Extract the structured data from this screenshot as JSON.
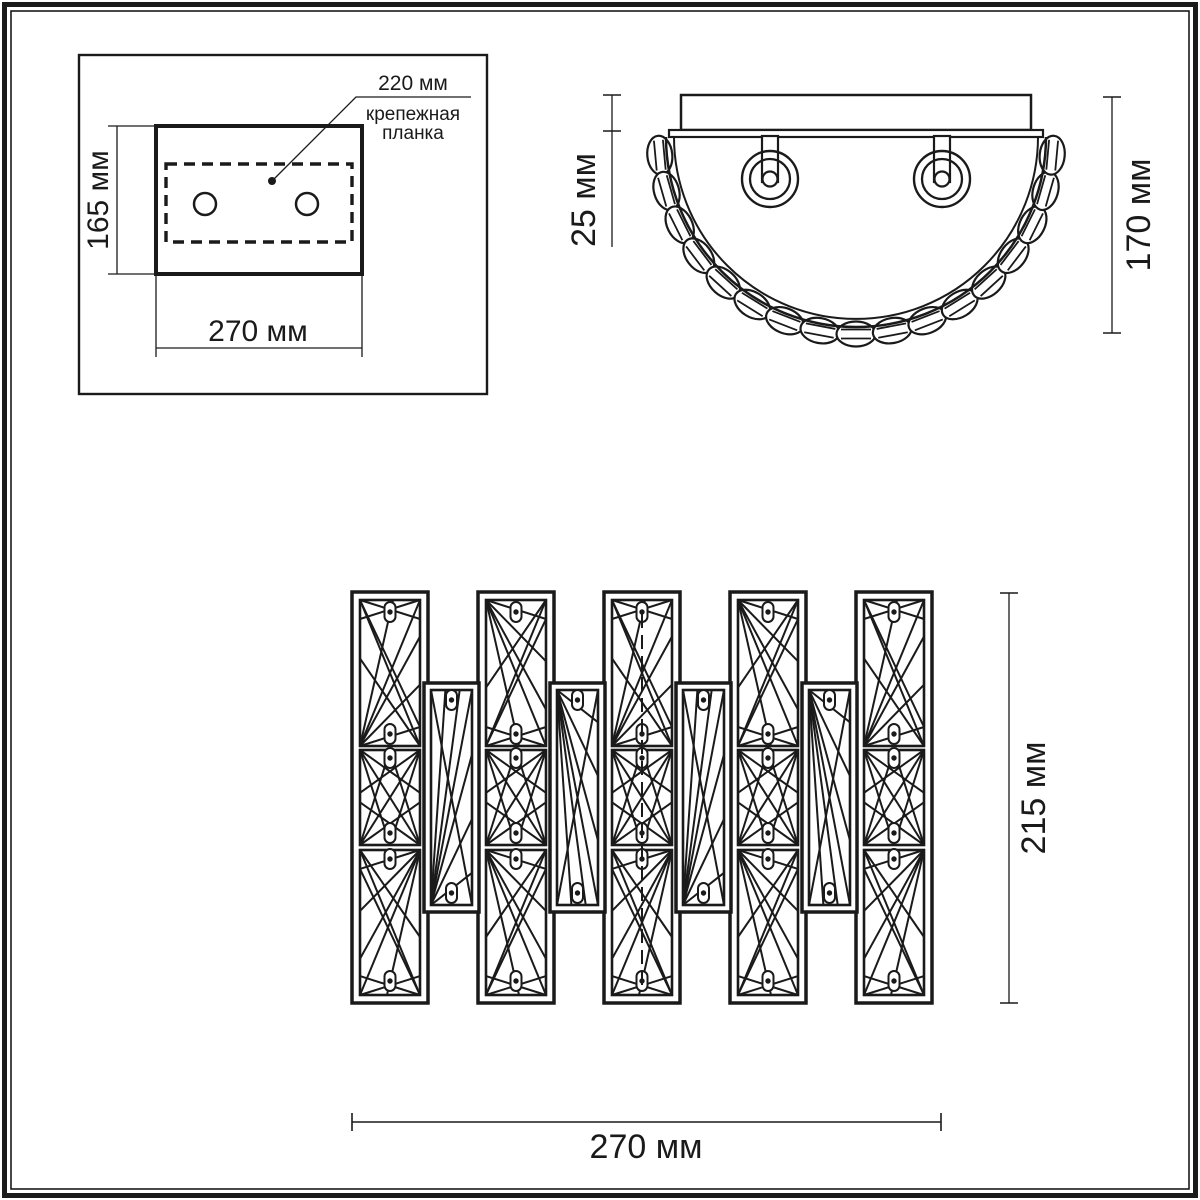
{
  "ink_color": "#1a1a1a",
  "drawing_title": "wall-lamp dimensional drawing",
  "views": {
    "mounting_plate_view": {
      "height_label": "165 мм",
      "width_label": "270 мм",
      "bracket_length_label": "220 мм",
      "bracket_caption_line1": "крепежная",
      "bracket_caption_line2": "планка"
    },
    "top_view": {
      "plate_depth_label": "25 мм",
      "total_depth_label": "170 мм"
    },
    "front_view": {
      "height_label": "215 мм",
      "width_label": "270 мм"
    }
  }
}
